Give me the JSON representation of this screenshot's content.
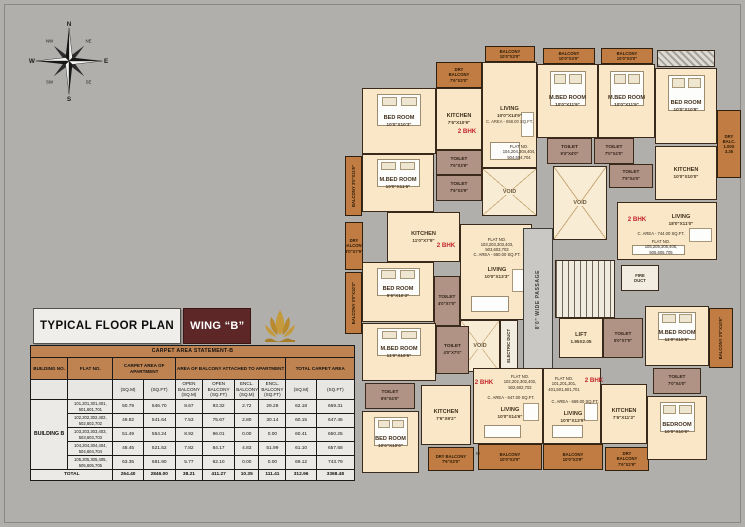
{
  "header": {
    "plan_title": "TYPICAL FLOOR PLAN",
    "wing_label": "WING “B”"
  },
  "compass": {
    "n": "N",
    "ne": "NE",
    "e": "E",
    "se": "SE",
    "s": "S",
    "sw": "SW",
    "w": "W",
    "nw": "NW"
  },
  "carpet_table": {
    "title": "CARPET AREA STATEMENT-B",
    "headers": {
      "building": "BUILDING NO.",
      "flat": "FLAT NO.",
      "carpet": "CARPET AREA OF APARTMENT",
      "balcony": "AREA OF BALCONY ATTACHED TO APARTMENT",
      "total": "TOTAL CARPET AREA"
    },
    "subheaders": [
      "(SQ.M)",
      "(SQ.FT)",
      "OPEN BALCONY (SQ.M)",
      "OPEN BALCONY (SQ.FT)",
      "ENCL. BALCONY (SQ.M)",
      "ENCL. BALCONY (SQ.FT)",
      "(SQ.M)",
      "(SQ.FT)"
    ],
    "building_name": "BUILDING B",
    "rows": [
      {
        "flat": "101,201,301,401, 501,601,701",
        "values": [
          "50.79",
          "546.70",
          "8.67",
          "93.32",
          "2.72",
          "29.28",
          "62.18",
          "669.31"
        ]
      },
      {
        "flat": "102,202,302,402, 502,602,702",
        "values": [
          "49.82",
          "541.64",
          "7.53",
          "75.67",
          "2.80",
          "30.14",
          "60.15",
          "647.45"
        ]
      },
      {
        "flat": "103,203,303,403, 503,603,703",
        "values": [
          "51.49",
          "554.24",
          "8.92",
          "96.01",
          "0.00",
          "0.00",
          "60.41",
          "650.25"
        ]
      },
      {
        "flat": "104,204,304,404, 504,604,704",
        "values": [
          "48.45",
          "521.52",
          "7.82",
          "84.17",
          "4.83",
          "51.99",
          "61.10",
          "657.68"
        ]
      },
      {
        "flat": "105,205,305,405, 505,605,705",
        "values": [
          "63.35",
          "681.90",
          "5.77",
          "62.10",
          "0.00",
          "0.00",
          "69.12",
          "743.79"
        ]
      }
    ],
    "total_label": "TOTAL",
    "totals": [
      "264.40",
      "2846.00",
      "38.21",
      "411.27",
      "10.35",
      "111.41",
      "312.96",
      "3368.48"
    ]
  },
  "plan": {
    "rooms": [
      {
        "n": "dry-balcony-104",
        "t": "balcony",
        "x": 91,
        "y": 52,
        "w": 46,
        "h": 26,
        "lines": [
          "DRY",
          "BALCONY",
          "7'6\"X3'0\""
        ]
      },
      {
        "n": "balcony-top-1",
        "t": "balcony",
        "x": 140,
        "y": 36,
        "w": 50,
        "h": 16,
        "lines": [
          "BALCONY",
          "10'0\"X3'0\""
        ]
      },
      {
        "n": "balcony-top-2",
        "t": "balcony",
        "x": 198,
        "y": 38,
        "w": 52,
        "h": 16,
        "lines": [
          "BALCONY",
          "10'0\"X3'0\""
        ]
      },
      {
        "n": "balcony-top-3",
        "t": "balcony",
        "x": 256,
        "y": 38,
        "w": 52,
        "h": 16,
        "lines": [
          "BALCONY",
          "10'0\"X3'0\""
        ]
      },
      {
        "n": "window-hatch-tr",
        "t": "hatch",
        "x": 312,
        "y": 40,
        "w": 58,
        "h": 17,
        "lines": []
      },
      {
        "n": "bedroom-104",
        "t": "room",
        "bed": 1,
        "x": 17,
        "y": 78,
        "w": 74,
        "h": 66,
        "lines": [
          "BED ROOM",
          "10'0\"X10'3\""
        ]
      },
      {
        "n": "kitchen-104",
        "t": "room",
        "x": 91,
        "y": 78,
        "w": 46,
        "h": 62,
        "lines": [
          "KITCHEN",
          "7'6\"X10'9\""
        ]
      },
      {
        "n": "living-104",
        "t": "room",
        "sofa": 1,
        "x": 137,
        "y": 52,
        "w": 55,
        "h": 106,
        "lines": [
          "LIVING",
          "10'0\"X14'9\"",
          "C. AREA - 658.00 SQ.FT."
        ]
      },
      {
        "n": "mbedroom-104",
        "t": "room",
        "bed": 1,
        "x": 17,
        "y": 144,
        "w": 72,
        "h": 58,
        "lines": [
          "M.BED ROOM",
          "10'0\"X11'6\""
        ]
      },
      {
        "n": "balcony-left-1",
        "t": "balcony",
        "v": 1,
        "x": 0,
        "y": 146,
        "w": 17,
        "h": 60,
        "lines": [
          "BALCONY 3'0\"X11'6\""
        ]
      },
      {
        "n": "toilet-104-a",
        "t": "toilet",
        "x": 91,
        "y": 140,
        "w": 46,
        "h": 25,
        "lines": [
          "TOILET",
          "7'6\"X3'9\""
        ]
      },
      {
        "n": "toilet-104-b",
        "t": "toilet",
        "x": 91,
        "y": 165,
        "w": 46,
        "h": 26,
        "lines": [
          "TOILET",
          "7'6\"X3'9\""
        ]
      },
      {
        "n": "void-1",
        "t": "void",
        "x": 137,
        "y": 158,
        "w": 55,
        "h": 48,
        "lines": [
          "VOID"
        ]
      },
      {
        "n": "bhk-label-104",
        "t": "label-red",
        "x": 102,
        "y": 116,
        "w": 40,
        "h": 11,
        "lines": [
          "2 BHK"
        ]
      },
      {
        "n": "flat-label-104",
        "t": "label-tiny",
        "x": 148,
        "y": 128,
        "w": 52,
        "h": 28,
        "lines": [
          "FLAT NO.",
          "104,204,304,404,",
          "504,604,704"
        ]
      },
      {
        "n": "mbedroom-tr-1",
        "t": "room",
        "bed": 1,
        "x": 192,
        "y": 54,
        "w": 61,
        "h": 74,
        "lines": [
          "M.BED ROOM",
          "10'0\"X11'9\""
        ]
      },
      {
        "n": "mbedroom-tr-2",
        "t": "room",
        "bed": 1,
        "x": 253,
        "y": 54,
        "w": 57,
        "h": 74,
        "lines": [
          "M.BED ROOM",
          "10'0\"X11'9\""
        ]
      },
      {
        "n": "bedroom-tr",
        "t": "room",
        "bed": 1,
        "x": 310,
        "y": 58,
        "w": 62,
        "h": 76,
        "lines": [
          "BED ROOM",
          "10'0\"X10'9\""
        ]
      },
      {
        "n": "dry-balcony-right",
        "t": "balcony",
        "x": 372,
        "y": 100,
        "w": 24,
        "h": 68,
        "lines": [
          "DRY",
          "BALC.",
          "1.00X",
          "3.35"
        ]
      },
      {
        "n": "toilet-tr-1",
        "t": "toilet",
        "x": 202,
        "y": 128,
        "w": 45,
        "h": 26,
        "lines": [
          "TOILET",
          "9'3\"X4'0\""
        ]
      },
      {
        "n": "toilet-tr-2",
        "t": "toilet",
        "x": 249,
        "y": 128,
        "w": 40,
        "h": 26,
        "lines": [
          "TOILET",
          "7'0\"X4'0\""
        ]
      },
      {
        "n": "toilet-tr-3",
        "t": "toilet",
        "x": 264,
        "y": 154,
        "w": 44,
        "h": 24,
        "lines": [
          "TOILET",
          "7'9\"X4'0\""
        ]
      },
      {
        "n": "kitchen-tr",
        "t": "room",
        "x": 310,
        "y": 136,
        "w": 62,
        "h": 54,
        "lines": [
          "KITCHEN",
          "10'0\"X10'0\""
        ]
      },
      {
        "n": "void-2",
        "t": "void",
        "x": 208,
        "y": 156,
        "w": 54,
        "h": 74,
        "lines": [
          "VOID"
        ]
      },
      {
        "n": "dry-balcony-left",
        "t": "balcony",
        "x": 0,
        "y": 212,
        "w": 18,
        "h": 48,
        "lines": [
          "DRY",
          "BALCONY",
          "3'0\"X7'9\""
        ]
      },
      {
        "n": "kitchen-103",
        "t": "room",
        "x": 42,
        "y": 202,
        "w": 73,
        "h": 50,
        "lines": [
          "KITCHEN",
          "11'0\"X7'9\""
        ]
      },
      {
        "n": "living-103",
        "t": "room",
        "sofa": 1,
        "x": 115,
        "y": 214,
        "w": 72,
        "h": 96,
        "lines": []
      },
      {
        "n": "flat-label-103",
        "t": "label-tiny",
        "x": 120,
        "y": 222,
        "w": 64,
        "h": 30,
        "lines": [
          "FLAT NO.",
          "103,203,303,403,",
          "503,603,703",
          "C. AREA - 650.00 SQ.FT."
        ]
      },
      {
        "n": "bhk-label-103",
        "t": "label-red",
        "x": 84,
        "y": 230,
        "w": 34,
        "h": 11,
        "lines": [
          "2 BHK"
        ]
      },
      {
        "n": "living-label-103",
        "t": "label",
        "x": 128,
        "y": 254,
        "w": 48,
        "h": 18,
        "lines": [
          "LIVING",
          "10'0\"X13'3\""
        ]
      },
      {
        "n": "bedroom-103",
        "t": "room",
        "bed": 1,
        "x": 17,
        "y": 252,
        "w": 72,
        "h": 60,
        "lines": [
          "BED ROOM",
          "9'6\"X10'3\""
        ]
      },
      {
        "n": "balcony-left-2",
        "t": "balcony",
        "v": 1,
        "x": 0,
        "y": 262,
        "w": 17,
        "h": 62,
        "lines": [
          "BALCONY 3'0\"X10'3\""
        ]
      },
      {
        "n": "toilet-103",
        "t": "toilet",
        "x": 89,
        "y": 266,
        "w": 26,
        "h": 50,
        "lines": [
          "TOILET",
          "4'0\"X7'0\""
        ]
      },
      {
        "n": "void-3",
        "t": "void",
        "x": 115,
        "y": 310,
        "w": 40,
        "h": 52,
        "lines": [
          "VOID"
        ]
      },
      {
        "n": "electric-duct",
        "t": "duct",
        "v": 1,
        "x": 155,
        "y": 310,
        "w": 18,
        "h": 52,
        "lines": [
          "ELECTRIC DUCT"
        ]
      },
      {
        "n": "passage",
        "t": "passage",
        "v": 1,
        "x": 178,
        "y": 218,
        "w": 30,
        "h": 144,
        "lines": [
          "8'0\" WIDE PASSAGE"
        ]
      },
      {
        "n": "staircase",
        "t": "stair",
        "x": 210,
        "y": 250,
        "w": 60,
        "h": 58,
        "lines": []
      },
      {
        "n": "lift",
        "t": "room",
        "x": 214,
        "y": 308,
        "w": 44,
        "h": 40,
        "lines": [
          "LIFT",
          "1.95X2.05"
        ]
      },
      {
        "n": "toilet-core",
        "t": "toilet",
        "x": 258,
        "y": 308,
        "w": 40,
        "h": 40,
        "lines": [
          "TOILET",
          "5'0\"X7'0\""
        ]
      },
      {
        "n": "fire-duct",
        "t": "duct",
        "x": 276,
        "y": 255,
        "w": 38,
        "h": 26,
        "lines": [
          "FIRE",
          "DUCT"
        ]
      },
      {
        "n": "living-105",
        "t": "room",
        "sofa": 1,
        "x": 272,
        "y": 192,
        "w": 100,
        "h": 58,
        "lines": []
      },
      {
        "n": "bhk-label-105",
        "t": "label-red",
        "x": 276,
        "y": 204,
        "w": 32,
        "h": 11,
        "lines": [
          "2 BHK"
        ]
      },
      {
        "n": "living-label-105",
        "t": "label",
        "x": 308,
        "y": 202,
        "w": 56,
        "h": 16,
        "lines": [
          "LIVING",
          "18'0\"X11'0\""
        ]
      },
      {
        "n": "carea-label-105",
        "t": "label-tiny",
        "x": 276,
        "y": 220,
        "w": 80,
        "h": 8,
        "lines": [
          "C. AREA - 744.00 SQ.FT."
        ]
      },
      {
        "n": "flat-label-105",
        "t": "label-tiny",
        "x": 284,
        "y": 228,
        "w": 64,
        "h": 18,
        "lines": [
          "FLAT NO.",
          "105,205,305,405,",
          "505,605,705"
        ]
      },
      {
        "n": "mbedroom-102",
        "t": "room",
        "bed": 1,
        "x": 17,
        "y": 313,
        "w": 74,
        "h": 58,
        "lines": [
          "M.BED ROOM",
          "11'0\"X10'6\""
        ]
      },
      {
        "n": "toilet-102-a",
        "t": "toilet",
        "x": 91,
        "y": 316,
        "w": 33,
        "h": 48,
        "lines": [
          "TOILET",
          "4'0\"X7'0\""
        ]
      },
      {
        "n": "toilet-102-b",
        "t": "toilet",
        "x": 20,
        "y": 373,
        "w": 50,
        "h": 26,
        "lines": [
          "TOILET",
          "6'6\"X4'0\""
        ]
      },
      {
        "n": "kitchen-102",
        "t": "room",
        "x": 76,
        "y": 375,
        "w": 50,
        "h": 60,
        "lines": [
          "KITCHEN",
          "7'6\"X9'2\""
        ]
      },
      {
        "n": "bedroom-102",
        "t": "room",
        "bed": 1,
        "x": 17,
        "y": 401,
        "w": 57,
        "h": 62,
        "lines": [
          "BED ROOM",
          "10'0\"X10'0\""
        ]
      },
      {
        "n": "dry-balcony-102",
        "t": "balcony",
        "x": 83,
        "y": 437,
        "w": 46,
        "h": 24,
        "lines": [
          "DRY BALCONY",
          "7'6\"X3'0\""
        ]
      },
      {
        "n": "w-label",
        "t": "label-tiny",
        "x": 128,
        "y": 440,
        "w": 10,
        "h": 8,
        "lines": [
          "W"
        ]
      },
      {
        "n": "balcony-102",
        "t": "balcony",
        "x": 133,
        "y": 434,
        "w": 64,
        "h": 26,
        "lines": [
          "BALCONY",
          "10'0\"X3'0\""
        ]
      },
      {
        "n": "living-102",
        "t": "room",
        "sofa": 1,
        "x": 128,
        "y": 358,
        "w": 70,
        "h": 76,
        "lines": []
      },
      {
        "n": "bhk-label-102",
        "t": "label-red",
        "x": 126,
        "y": 368,
        "w": 26,
        "h": 10,
        "lines": [
          "2 BHK"
        ]
      },
      {
        "n": "flat-label-102",
        "t": "label-tiny",
        "x": 150,
        "y": 362,
        "w": 50,
        "h": 20,
        "lines": [
          "FLAT NO.",
          "102,202,302,402,",
          "502,602,702"
        ]
      },
      {
        "n": "carea-label-102",
        "t": "label-tiny",
        "x": 136,
        "y": 384,
        "w": 60,
        "h": 8,
        "lines": [
          "C. AREA - 647.00 SQ.FT."
        ]
      },
      {
        "n": "living-label-102",
        "t": "label",
        "x": 140,
        "y": 394,
        "w": 50,
        "h": 18,
        "lines": [
          "LIVING",
          "10'0\"X14'6\""
        ]
      },
      {
        "n": "living-101",
        "t": "room",
        "sofa": 1,
        "x": 198,
        "y": 358,
        "w": 58,
        "h": 76,
        "lines": []
      },
      {
        "n": "flat-label-101",
        "t": "label-tiny",
        "x": 200,
        "y": 362,
        "w": 38,
        "h": 24,
        "lines": [
          "FLAT NO.",
          "101,201,301,",
          "401,501,601,701"
        ]
      },
      {
        "n": "bhk-label-101",
        "t": "label-red",
        "x": 236,
        "y": 366,
        "w": 26,
        "h": 10,
        "lines": [
          "2 BHK"
        ]
      },
      {
        "n": "carea-label-101",
        "t": "label-tiny",
        "x": 202,
        "y": 388,
        "w": 56,
        "h": 8,
        "lines": [
          "C. AREA - 669.00 SQ.FT."
        ]
      },
      {
        "n": "living-label-101",
        "t": "label",
        "x": 204,
        "y": 398,
        "w": 48,
        "h": 18,
        "lines": [
          "LIVING",
          "10'0\"X13'9\""
        ]
      },
      {
        "n": "balcony-101",
        "t": "balcony",
        "x": 198,
        "y": 434,
        "w": 60,
        "h": 26,
        "lines": [
          "BALCONY",
          "10'0\"X3'9\""
        ]
      },
      {
        "n": "dry-balcony-101",
        "t": "balcony",
        "x": 260,
        "y": 437,
        "w": 44,
        "h": 24,
        "lines": [
          "DRY",
          "BALCONY",
          "7'6\"X2'9\""
        ]
      },
      {
        "n": "kitchen-101",
        "t": "room",
        "x": 256,
        "y": 374,
        "w": 46,
        "h": 60,
        "lines": [
          "KITCHEN",
          "7'6\"X11'3\""
        ]
      },
      {
        "n": "mbedroom-101",
        "t": "room",
        "bed": 1,
        "x": 300,
        "y": 296,
        "w": 64,
        "h": 60,
        "lines": [
          "M.BED ROOM",
          "11'0\"X10'6\""
        ]
      },
      {
        "n": "balcony-right-101",
        "t": "balcony",
        "v": 1,
        "x": 364,
        "y": 298,
        "w": 24,
        "h": 60,
        "lines": [
          "BALCONY 3'0\"X10'6\""
        ]
      },
      {
        "n": "toilet-101",
        "t": "toilet",
        "x": 308,
        "y": 358,
        "w": 48,
        "h": 26,
        "lines": [
          "TOILET",
          "7'0\"X4'0\""
        ]
      },
      {
        "n": "bedroom-101",
        "t": "room",
        "bed": 1,
        "x": 302,
        "y": 386,
        "w": 60,
        "h": 64,
        "lines": [
          "BEDROOM",
          "10'0\"X10'0\""
        ]
      }
    ]
  }
}
